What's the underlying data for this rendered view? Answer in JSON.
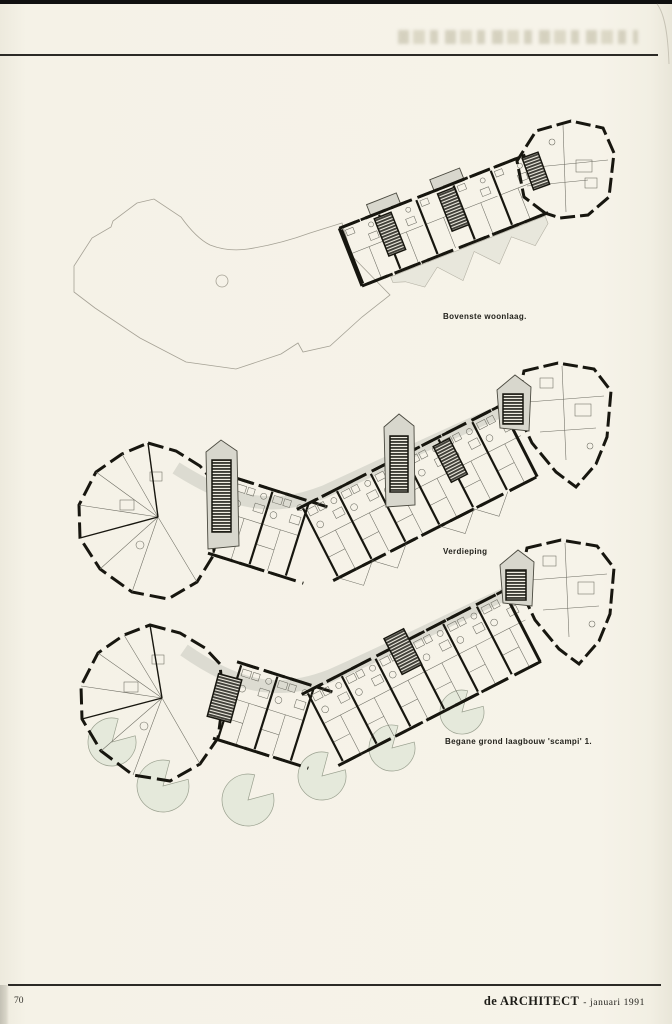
{
  "figures": [
    {
      "name": "bovenste-woonlaag",
      "caption": "Bovenste woonlaag."
    },
    {
      "name": "verdieping",
      "caption": "Verdieping"
    },
    {
      "name": "begane-grond",
      "caption": "Begane grond laagbouw 'scampi' 1."
    }
  ],
  "footer": {
    "page_number": "70",
    "journal_title": "de ARCHITECT",
    "issue_suffix": "- januari 1991"
  },
  "colors": {
    "paper": "#f5f2e7",
    "ink": "#17160f",
    "shade_gray": "#d8d7cd",
    "shade_green": "#e5e9db"
  }
}
